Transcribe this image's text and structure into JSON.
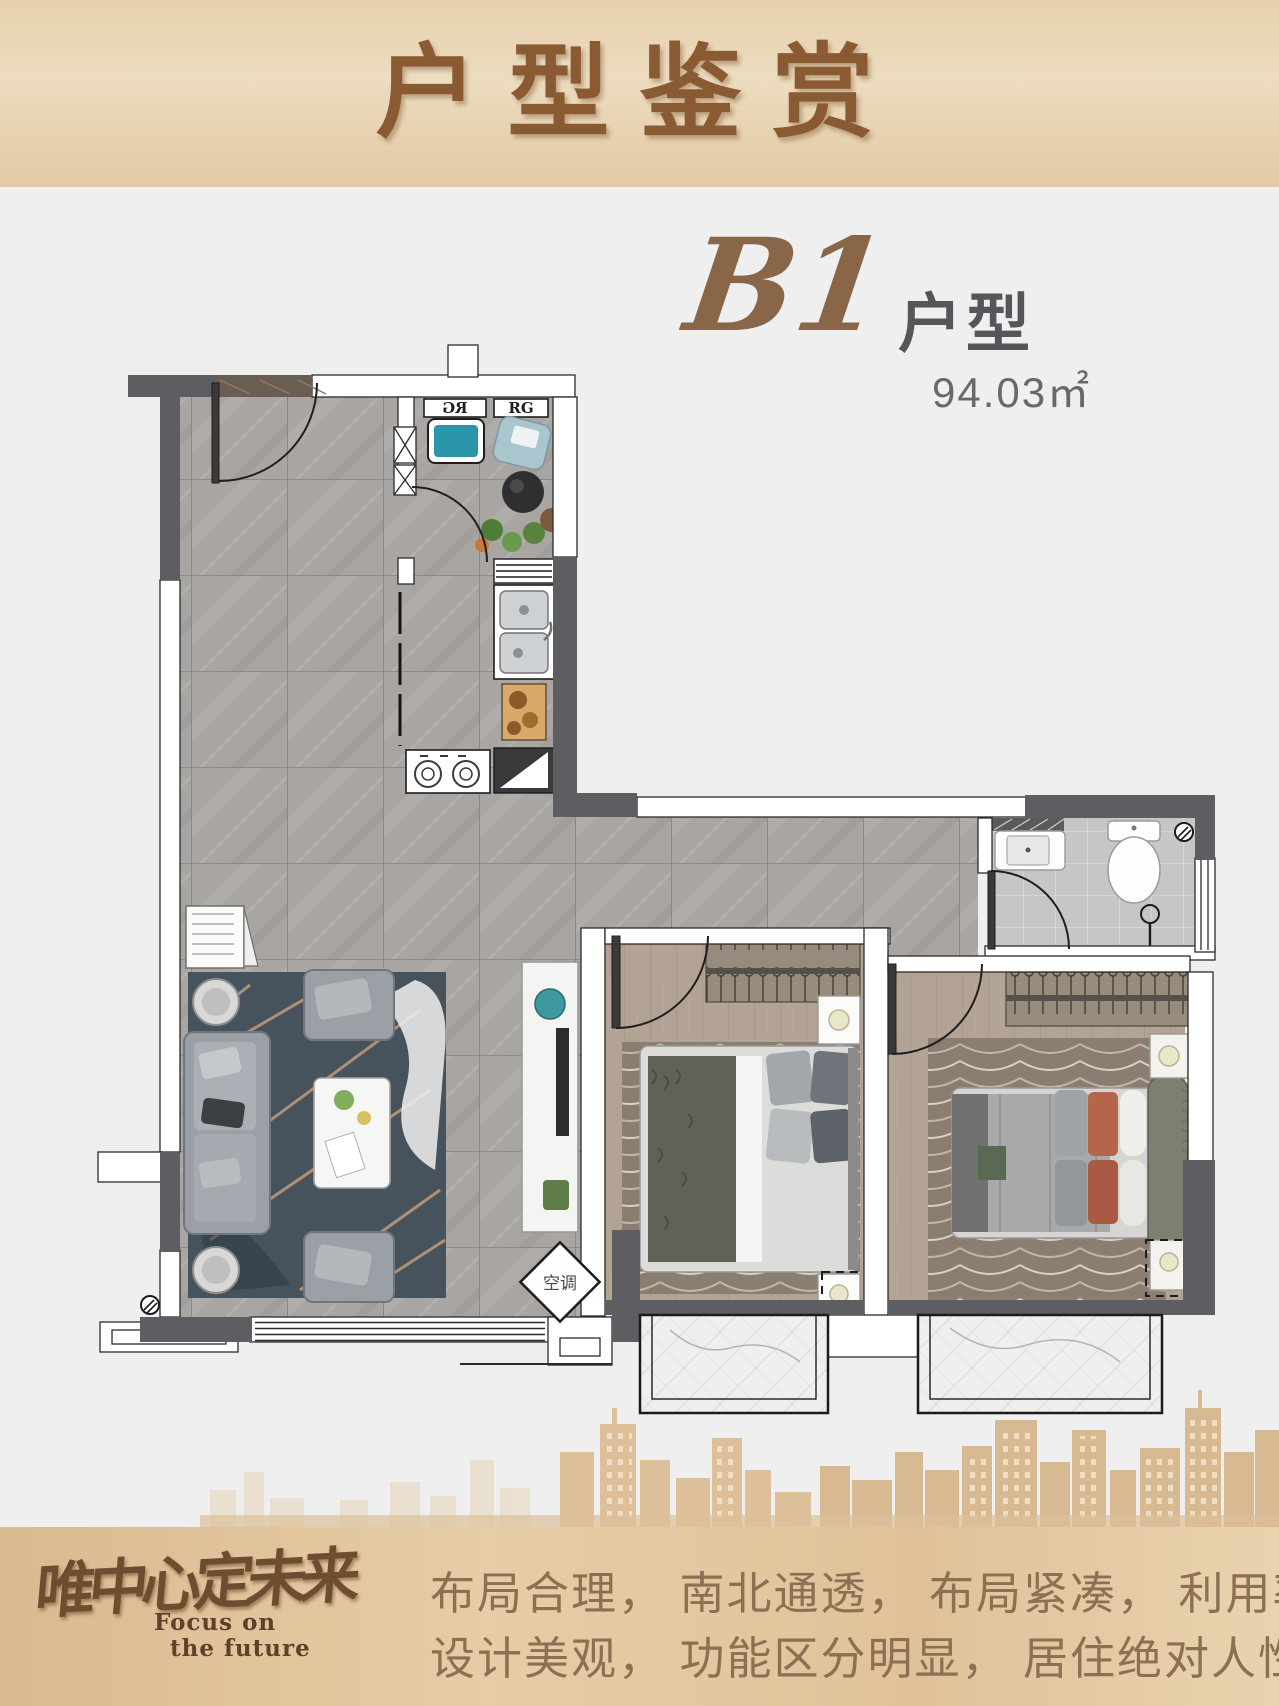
{
  "header": {
    "title": "户型鉴赏"
  },
  "unit": {
    "code": "B1",
    "type_label": "户型",
    "area": "94.03㎡"
  },
  "floorplan": {
    "fridge_label": "RG",
    "cabinet_label": "RG",
    "ac_label": "空调"
  },
  "footer": {
    "logo_cn": "唯中心定未来",
    "logo_en_line1": "Focus on",
    "logo_en_line2": "the future",
    "slogan_line1": "布局合理， 南北通透， 布局紧凑， 利用率高",
    "slogan_line2": "设计美观， 功能区分明显， 居住绝对人性化"
  },
  "colors": {
    "banner_tan": "#e3c9a3",
    "title_brown": "#8a5b33",
    "floor_marble_gray": "#a8a5a2",
    "wood_floor": "#b3a294",
    "wall_dark": "#5d5e61",
    "accent_teal": "#2b96aa",
    "skyline_tan": "#dcbf9a",
    "slogan_brown": "#8b7054"
  }
}
